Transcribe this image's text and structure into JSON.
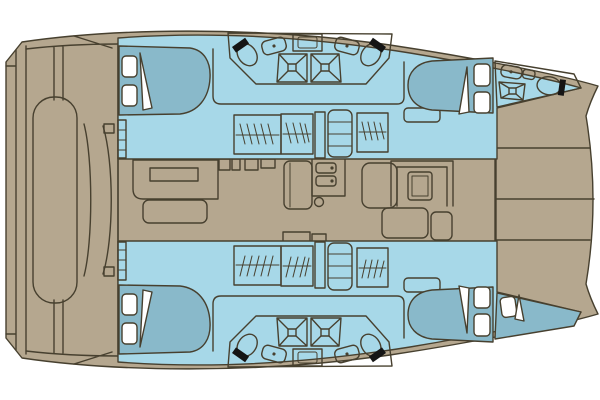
{
  "colors": {
    "bg": "#ffffff",
    "hull": "#b5a78f",
    "line": "#47402f",
    "cabin": "#a7d8e8",
    "bed": "#89b9ca",
    "head": "#c6dd90",
    "salon": "#f6d78d",
    "white": "#ffffff",
    "black": "#151515"
  },
  "diagram": {
    "type": "floor-plan",
    "subject": "catamaran yacht interior layout, top view, bow to the right",
    "orientation": {
      "bow": "right",
      "stern": "left",
      "port_hull": "top",
      "starboard_hull": "bottom"
    },
    "areas": [
      {
        "id": "aft-cockpit",
        "color_key": "hull",
        "features": [
          "transom-steps",
          "bench-seat",
          "curved-settee"
        ]
      },
      {
        "id": "foredeck",
        "color_key": "hull",
        "features": [
          "deck-planks",
          "forward-beam"
        ]
      },
      {
        "id": "salon",
        "color_key": "salon",
        "features": [
          "galley-counter",
          "galley-island",
          "galley-console",
          "double-sink-unit",
          "mast-post",
          "nav-console",
          "u-shaped-dinette",
          "dinette-table",
          "seats"
        ]
      },
      {
        "id": "port-aft-cabin",
        "color_key": "cabin",
        "features": [
          "double-bed",
          "pillows",
          "entry-steps"
        ]
      },
      {
        "id": "port-mid-heads",
        "color_key": "head",
        "features": [
          "toilet",
          "sink",
          "shower",
          "toilet",
          "sink",
          "shower",
          "cabinet"
        ]
      },
      {
        "id": "port-corridor",
        "color_key": "cabin",
        "features": [
          "wardrobe",
          "wardrobe",
          "companionway-steps",
          "wardrobe",
          "cabinet"
        ]
      },
      {
        "id": "port-forward-cabin",
        "color_key": "cabin",
        "features": [
          "double-bed",
          "pillows"
        ]
      },
      {
        "id": "port-bow-head",
        "color_key": "head",
        "features": [
          "sink",
          "shower",
          "toilet"
        ]
      },
      {
        "id": "starboard-aft-cabin",
        "color_key": "cabin",
        "features": [
          "double-bed",
          "pillows",
          "entry-steps"
        ]
      },
      {
        "id": "starboard-mid-heads",
        "color_key": "head",
        "features": [
          "toilet",
          "sink",
          "shower",
          "toilet",
          "sink",
          "shower",
          "cabinet"
        ]
      },
      {
        "id": "starboard-corridor",
        "color_key": "cabin",
        "features": [
          "wardrobe",
          "wardrobe",
          "companionway-steps",
          "wardrobe",
          "cabinet"
        ]
      },
      {
        "id": "starboard-forward-cabin",
        "color_key": "cabin",
        "features": [
          "double-bed",
          "pillows"
        ]
      },
      {
        "id": "starboard-bow-berth",
        "color_key": "bed",
        "features": [
          "single-berth",
          "pillow"
        ]
      }
    ],
    "fixture_counts": {
      "double_beds": 4,
      "single_berths": 1,
      "toilets": 5,
      "sinks": 5,
      "showers": 5,
      "wardrobes": 6,
      "companionway_steps": 2
    }
  }
}
